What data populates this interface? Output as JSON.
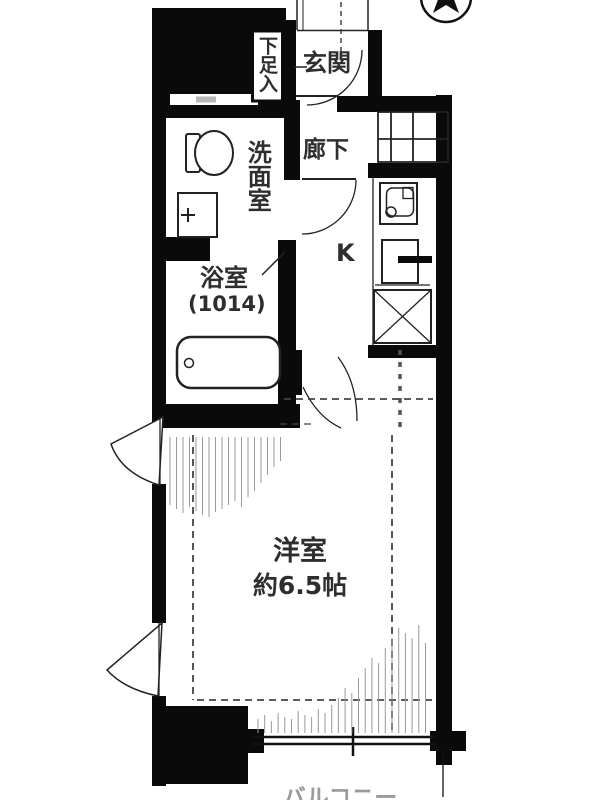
{
  "rooms": {
    "shoe_cabinet": "下足入",
    "entrance": "玄関",
    "washroom": "洗面室",
    "hallway": "廊下",
    "bathroom": "浴室",
    "bathroom_size": "(1014)",
    "kitchen": "K",
    "main_room": "洋室",
    "main_room_size": "約6.5帖",
    "balcony": "バルコニー"
  },
  "icons": {
    "compass": "north-arrow",
    "fixtures": [
      "toilet",
      "washbasin",
      "bathtub",
      "kitchen-sink",
      "kitchen-counter",
      "refrigerator-space",
      "meter-box-grid",
      "casement-window",
      "sliding-window"
    ]
  },
  "colors": {
    "wall": "#0a0a0a",
    "line": "#222222",
    "dash": "#444444",
    "hatch": "#9a9a9a",
    "text": "#2e2e2e",
    "balcony_text": "#9b9b9b"
  }
}
